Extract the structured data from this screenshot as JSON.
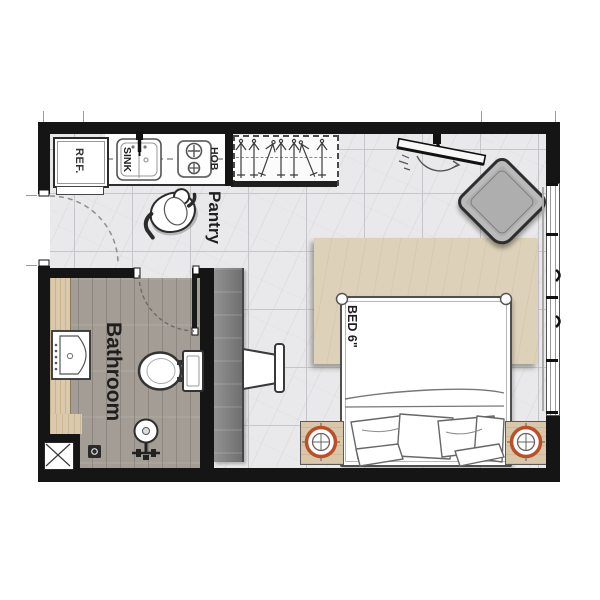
{
  "floorplan": {
    "type": "studio-apartment-floor-plan",
    "labels": {
      "refrigerator": "REF.",
      "sink": "SINK",
      "hob": "HOB",
      "pantry": "Pantry",
      "bathroom": "Bathroom",
      "bed": "BED 6\""
    },
    "rooms": [
      {
        "name": "Pantry"
      },
      {
        "name": "Bathroom"
      },
      {
        "name": "Bedroom"
      }
    ],
    "icons": {
      "refrigerator-icon": "rect-box",
      "kitchen-sink-icon": "basin-with-faucet",
      "hob-icon": "two-burner-cooktop",
      "wardrobe-icon": "dashed-box-with-hangers",
      "tv-icon": "wall-mounted-swivel-tv",
      "armchair-icon": "rotated-square-chair",
      "person-icon": "top-view-figure",
      "bed-icon": "double-bed-with-pillows",
      "nightstand-lamp-icon": "circle-crosshair",
      "desk-chair-icon": "side-chair",
      "toilet-icon": "toilet-top-view",
      "vanity-sink-icon": "wash-basin",
      "shower-head-icon": "circle-on-stem",
      "floor-drain-icon": "small-square-drain",
      "service-shaft-icon": "box-with-x",
      "door-swing-icon": "dashed-quarter-arc",
      "window-icon": "double-line-strip"
    },
    "colors": {
      "wall": "#151515",
      "tile_floor": "#e9e9eb",
      "tile_grid": "#c6c6ca",
      "bathroom_floor": "#a39d95",
      "wood_counter": "#dbc9ac",
      "rug": "#ddd1b9",
      "nightstand": "#d8c7a8",
      "lamp_ring": "#bb4f28",
      "armchair": "#aeaeae",
      "desk": "#7e7e7e"
    }
  }
}
